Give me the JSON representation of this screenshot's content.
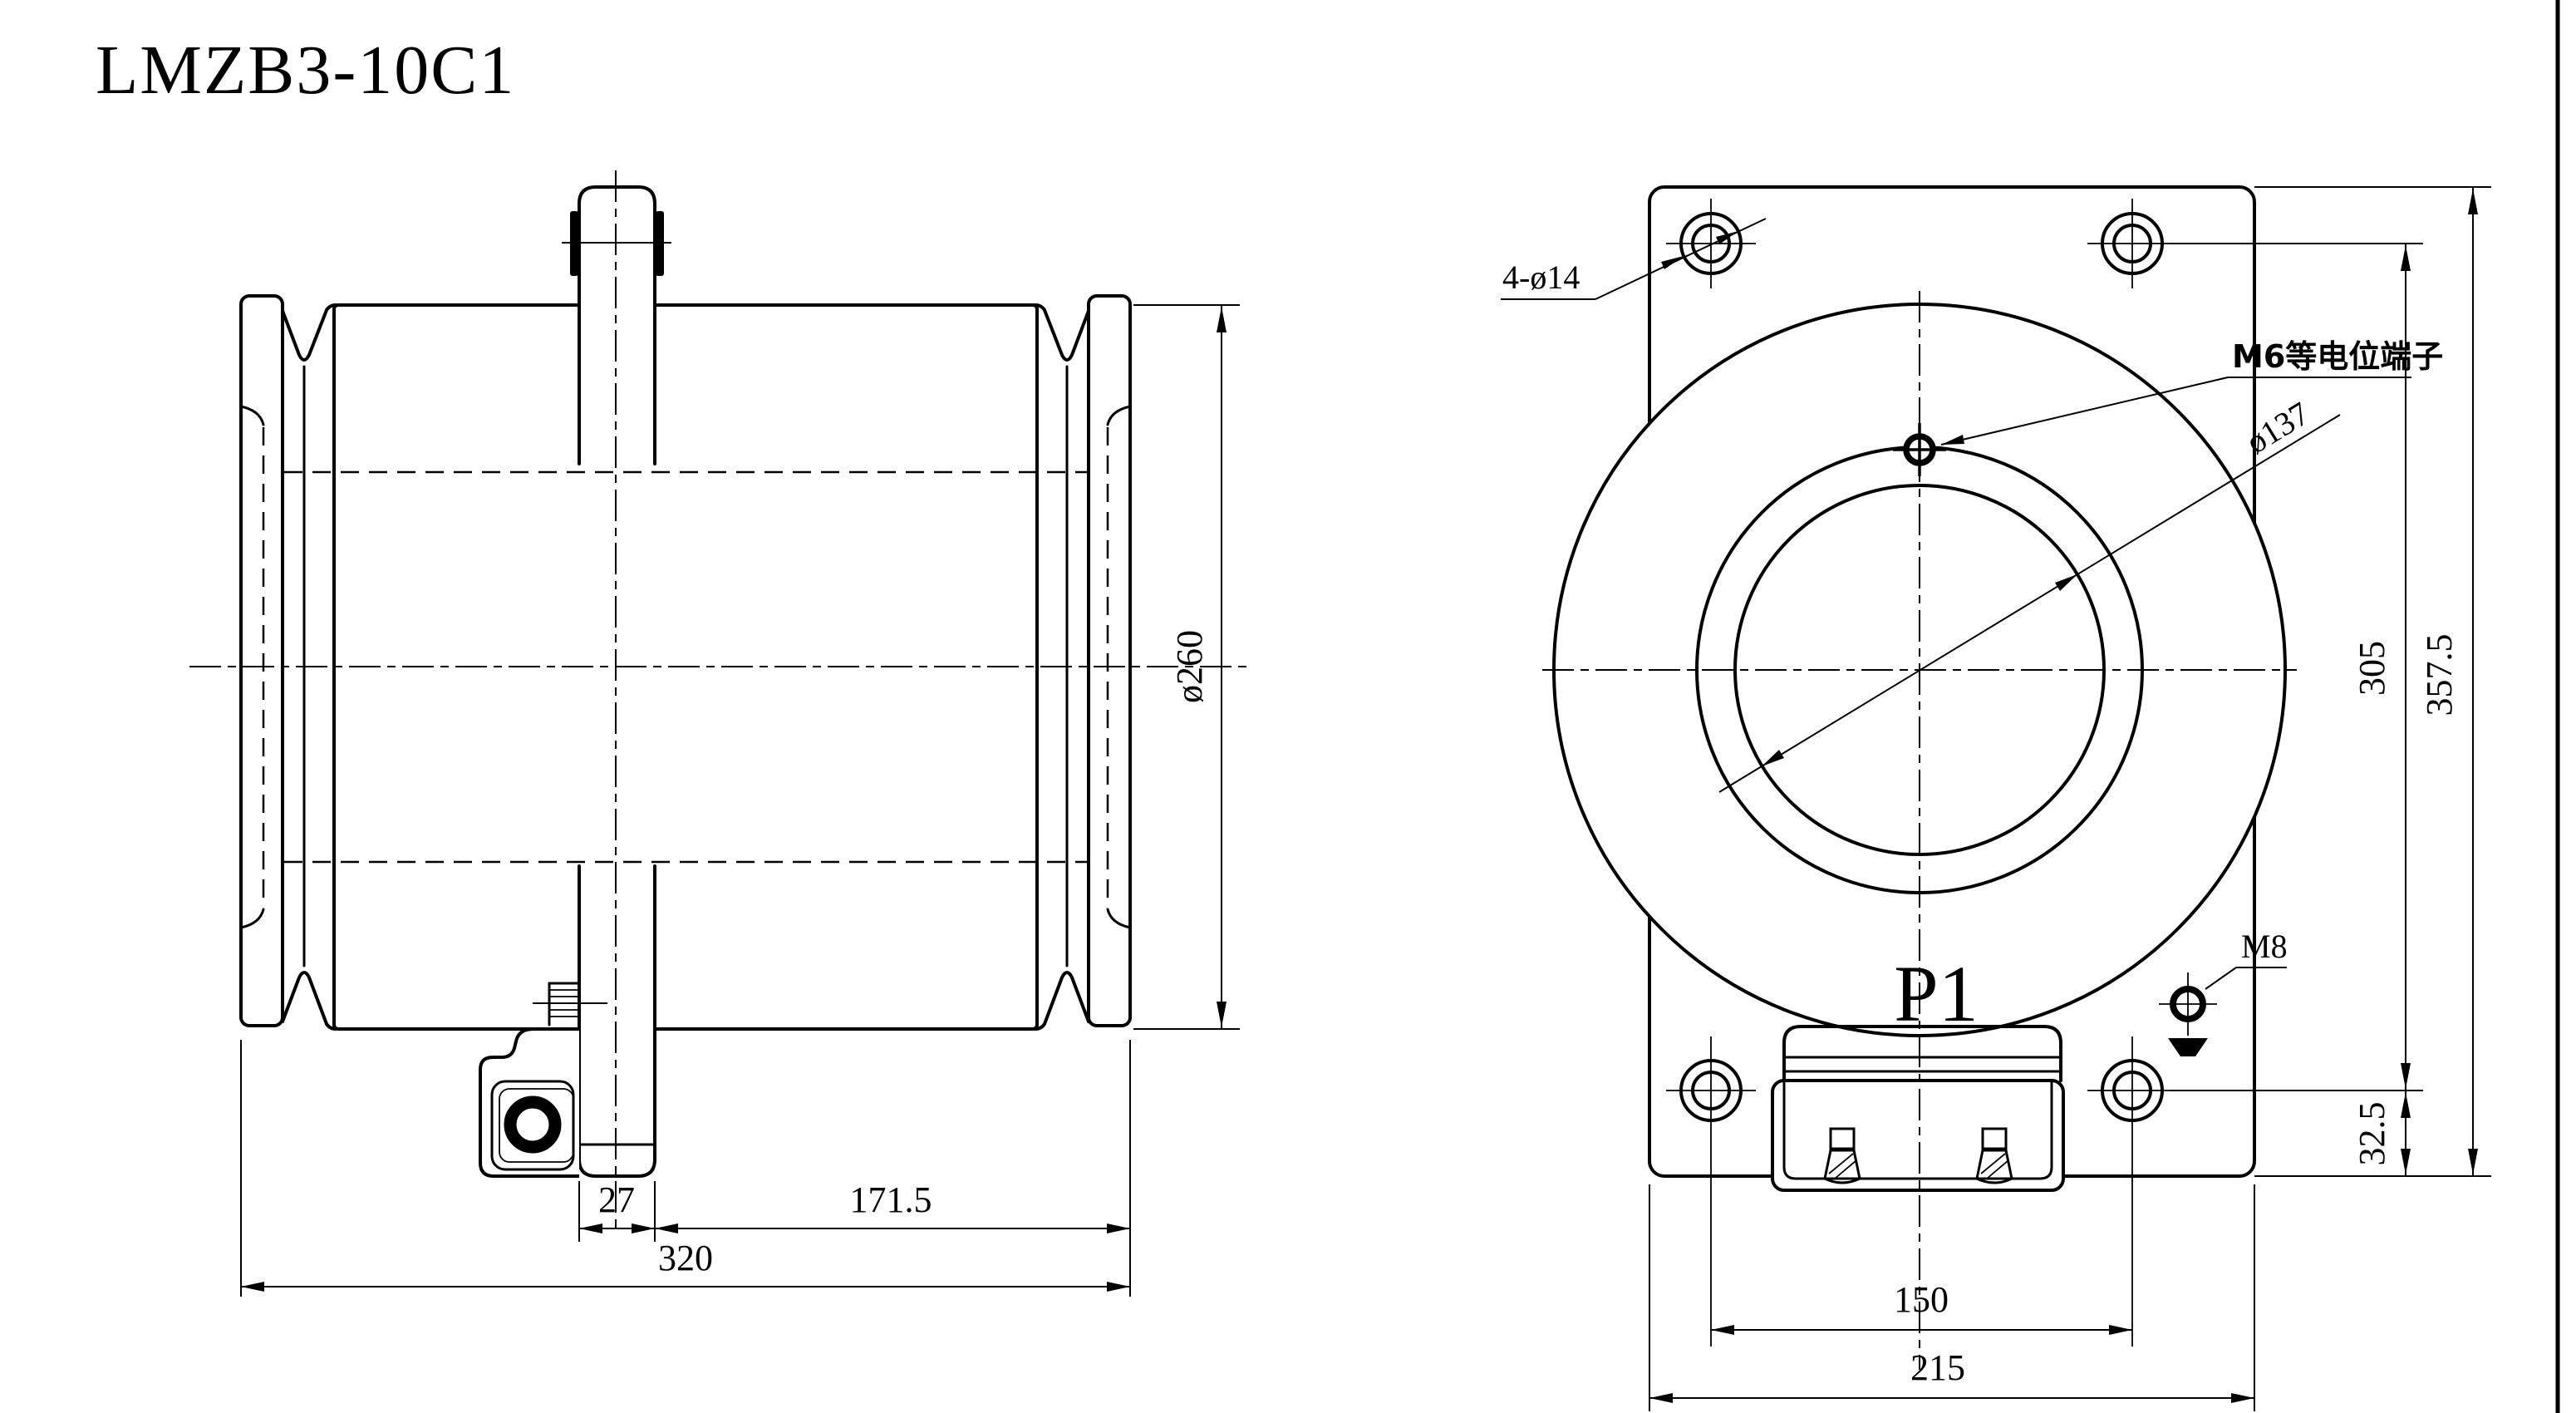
{
  "drawing": {
    "title": "LMZB3-10C1",
    "side_view": {
      "dim_tab_width": "27",
      "dim_tab_to_edge": "171.5",
      "dim_overall_length": "320",
      "dim_outer_diameter": "ø260"
    },
    "front_view": {
      "label_mounting_holes": "4-ø14",
      "label_equipotential_terminal": "M6等电位端子",
      "label_bore_diameter": "ø137",
      "label_primary_terminal": "P1",
      "label_ground_bolt": "M8",
      "dim_hole_spacing_vertical": "305",
      "dim_overall_height": "357.5",
      "dim_bottom_hole_offset": "32.5",
      "dim_terminal_screw_spacing": "150",
      "dim_hole_spacing_horizontal": "215"
    },
    "colors": {
      "line": "#000000",
      "background": "#ffffff"
    }
  }
}
